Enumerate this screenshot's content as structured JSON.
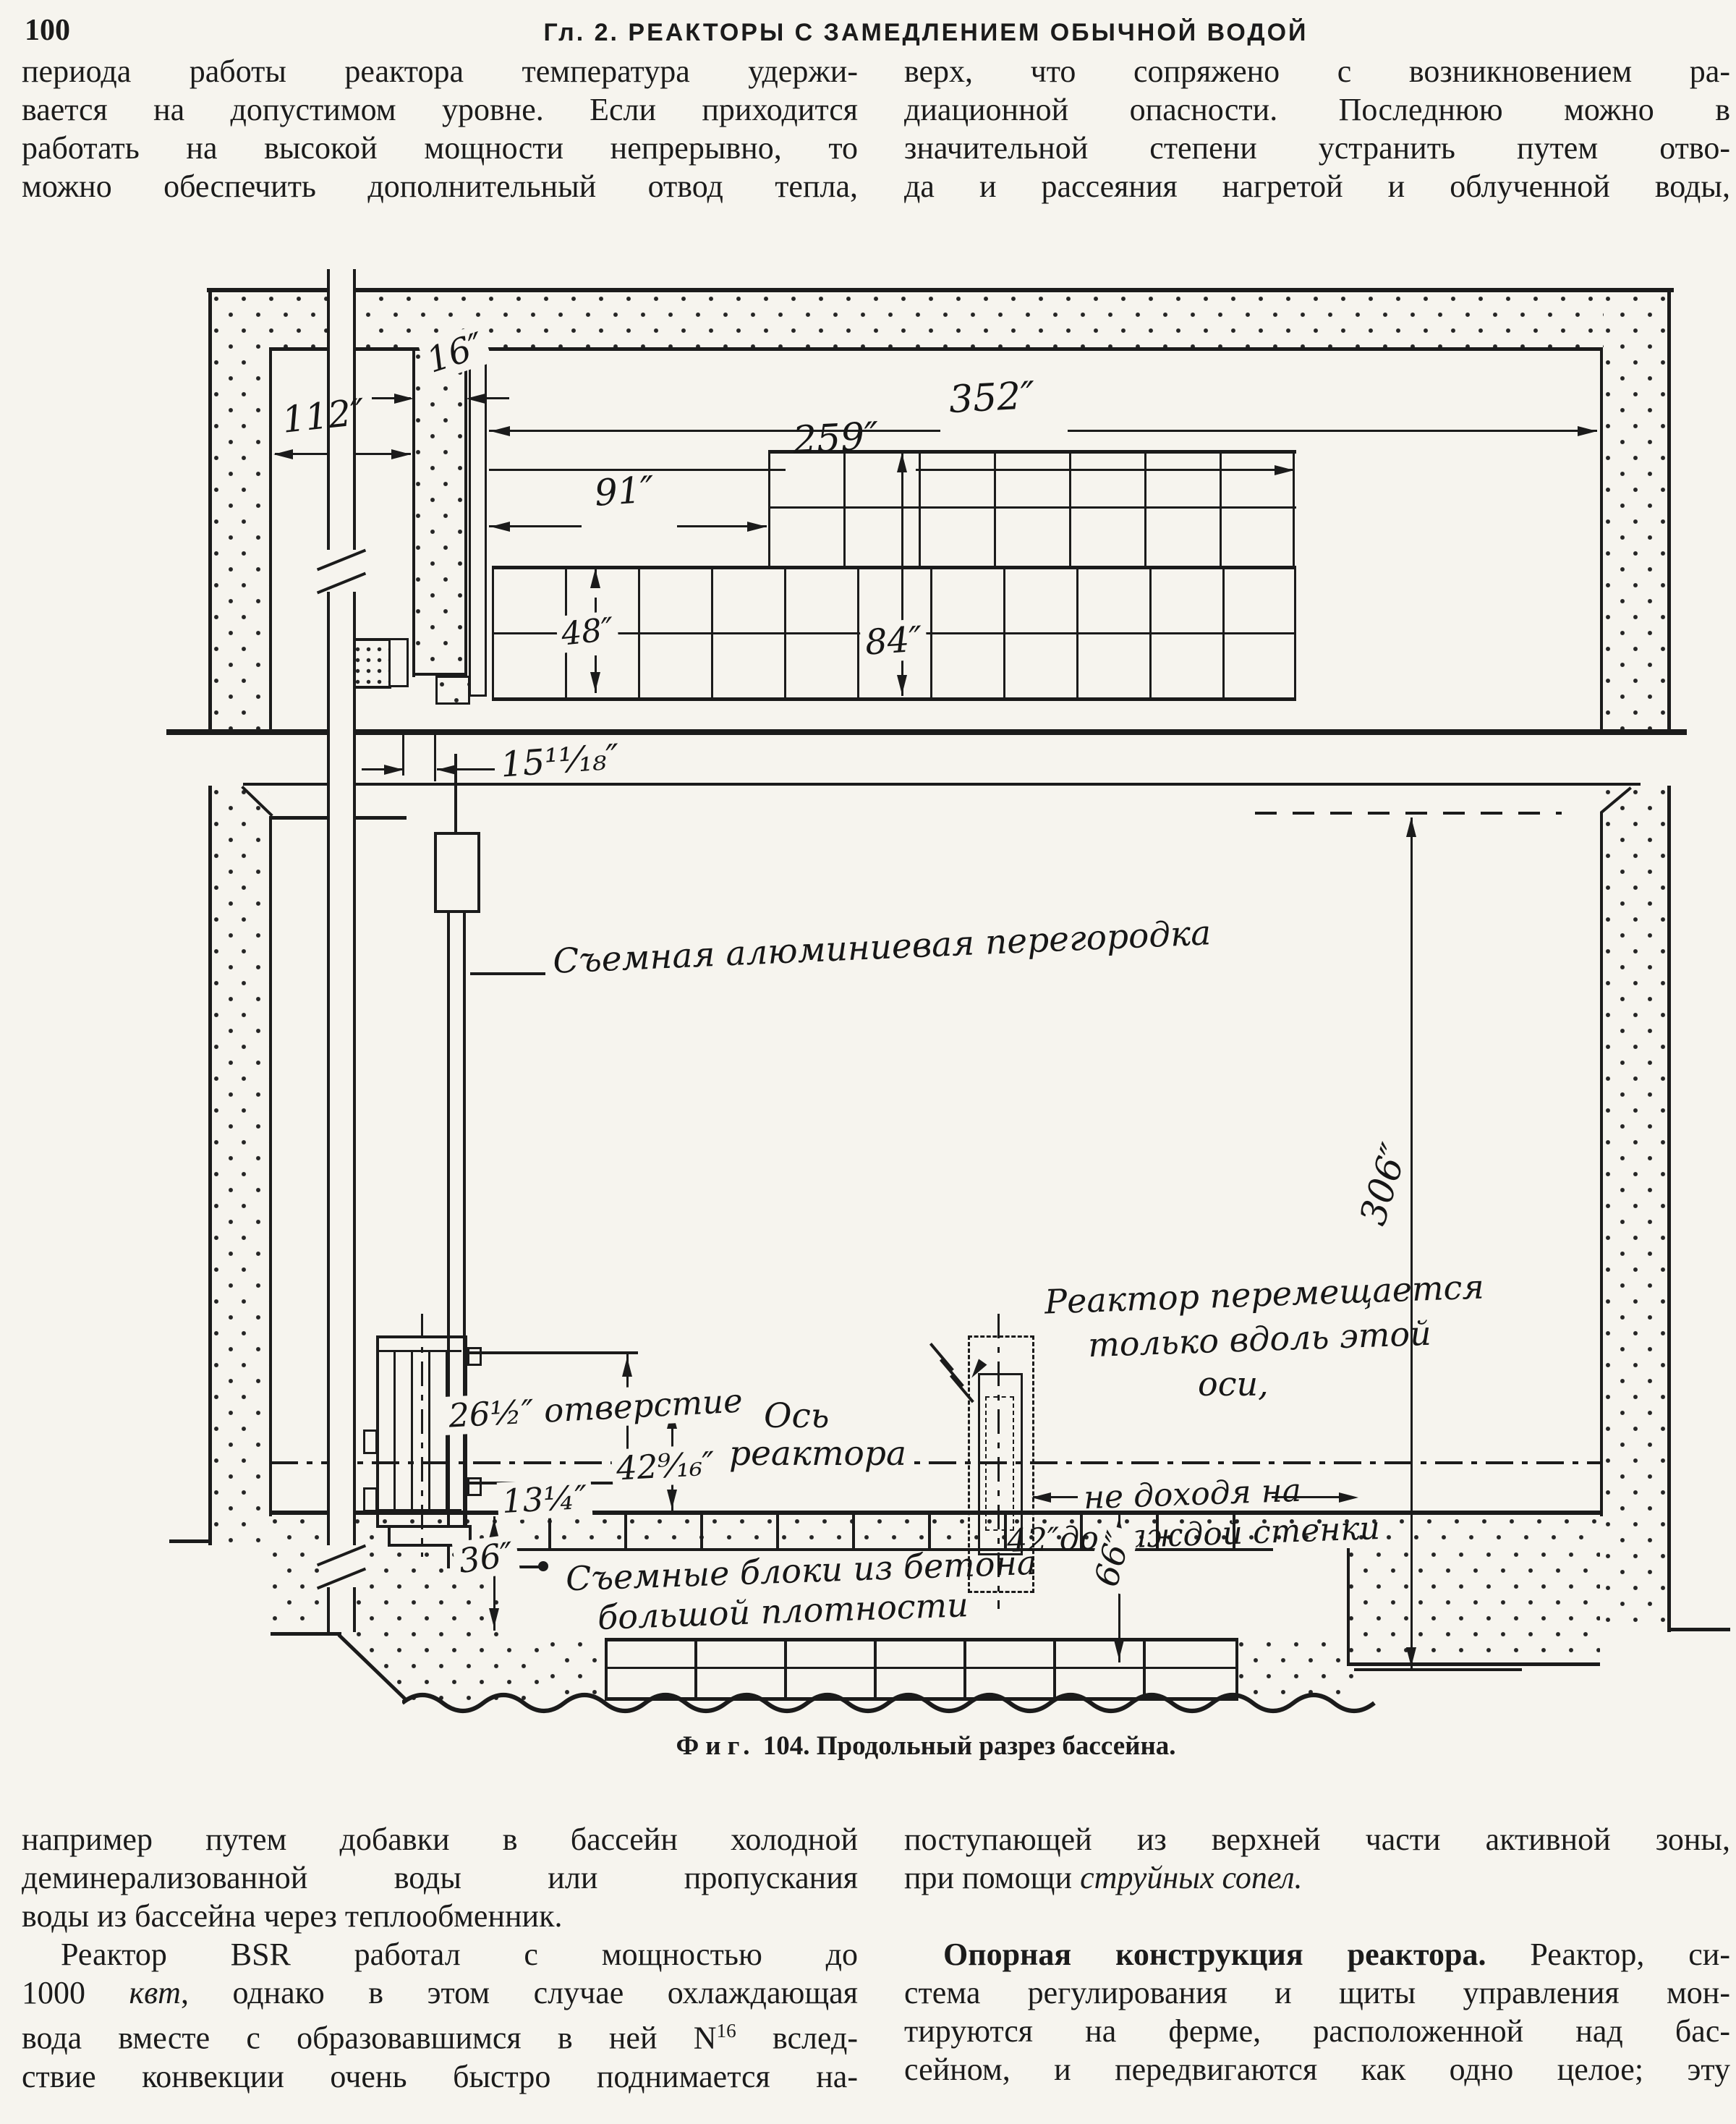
{
  "page": {
    "number": "100",
    "header": "Гл. 2. РЕАКТОРЫ С ЗАМЕДЛЕНИЕМ ОБЫЧНОЙ ВОДОЙ"
  },
  "top_left": [
    "периода работы реактора температура удержи-",
    "вается на допустимом уровне. Если приходится",
    "работать на высокой мощности непрерывно, то",
    "можно обеспечить дополнительный отвод тепла,"
  ],
  "top_right": [
    "верх, что сопряжено с возникновением ра-",
    "диационной опасности. Последнюю можно в",
    "значительной степени устранить путем отво-",
    "да и рассеяния нагретой и облученной воды,"
  ],
  "bottom_left": [
    "например путем добавки в бассейн холодной",
    "деминерализованной воды или пропускания",
    {
      "seg": [
        {
          "t": "воды из бассейна через теплообменник.",
          "s": ""
        }
      ],
      "last": true
    },
    {
      "seg": [
        {
          "t": "Реактор BSR работал с мощностью до",
          "s": ""
        }
      ],
      "ind": true
    },
    {
      "seg": [
        {
          "t": "1000 ",
          "s": ""
        },
        {
          "t": "квт",
          "s": "i"
        },
        {
          "t": ", однако в этом случае охлаждающая",
          "s": ""
        }
      ]
    },
    {
      "seg": [
        {
          "t": "вода вместе с образовавшимся в ней N",
          "s": ""
        },
        {
          "t": "16",
          "s": "sup"
        },
        {
          "t": " вслед-",
          "s": ""
        }
      ]
    },
    "ствие конвекции очень быстро поднимается на-"
  ],
  "bottom_right": [
    "поступающей из верхней части активной зоны,",
    {
      "seg": [
        {
          "t": "при помощи ",
          "s": ""
        },
        {
          "t": "струйных сопел.",
          "s": "i"
        }
      ],
      "last": true
    },
    {
      "gap": true
    },
    {
      "seg": [
        {
          "t": "Опорная конструкция реактора.",
          "s": "b"
        },
        {
          "t": " Реактор, си-",
          "s": ""
        }
      ],
      "ind": true
    },
    "стема регулирования и щиты управления мон-",
    "тируются на ферме, расположенной над бас-",
    "сейном, и передвигаются как одно целое; эту"
  ],
  "figure": {
    "caption_label": "Фиг.",
    "caption_text": " 104. Продольный разрез бассейна.",
    "labels": {
      "dim_16": "16″",
      "dim_112": "112″",
      "dim_352": "352″",
      "dim_259": "259″",
      "dim_91": "91″",
      "dim_84": "84″",
      "dim_48": "48″",
      "dim_15": "15¹¹⁄₁₈″",
      "partition": "Съемная алюминиевая перегородка",
      "axis1": "Ось",
      "axis2": "реактора",
      "opening": "26½″ отверстие",
      "dim_42": "42⁹⁄₁₆″",
      "dim_13": "13¼″",
      "dim_36": "36″",
      "dim_66": "66″",
      "dim_306": "306″",
      "reactor_move1": "Реактор перемещается",
      "reactor_move2": "только вдоль этой",
      "reactor_move3": "оси,",
      "not_closer1": "не доходя на",
      "not_closer2": "42″до каждой стенки",
      "blocks1": "Съемные блоки из бетона",
      "blocks2": "большой плотности"
    }
  }
}
